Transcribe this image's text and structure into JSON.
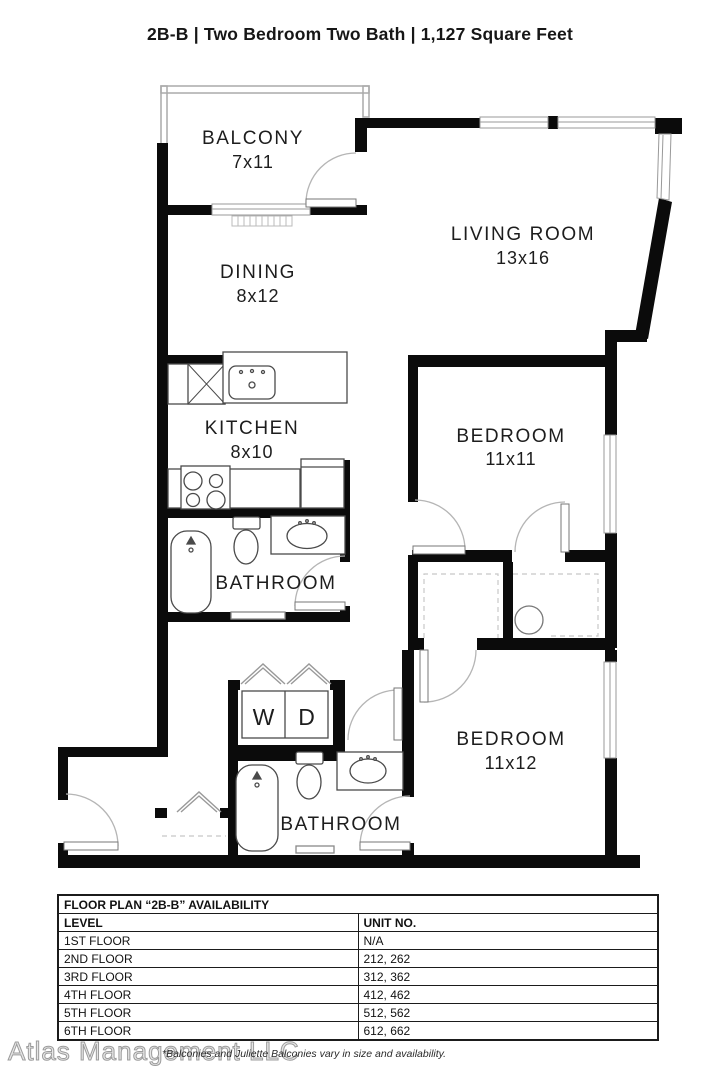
{
  "title": "2B-B | Two Bedroom Two Bath | 1,127 Square Feet",
  "plan": {
    "balcony": {
      "name": "BALCONY",
      "dims": "7x11"
    },
    "living_room": {
      "name": "LIVING ROOM",
      "dims": "13x16"
    },
    "dining": {
      "name": "DINING",
      "dims": "8x12"
    },
    "kitchen": {
      "name": "KITCHEN",
      "dims": "8x10"
    },
    "bedroom_1": {
      "name": "BEDROOM",
      "dims": "11x11"
    },
    "bathroom_1": {
      "name": "BATHROOM"
    },
    "laundry": {
      "washer": "W",
      "dryer": "D"
    },
    "bedroom_2": {
      "name": "BEDROOM",
      "dims": "11x12"
    },
    "bathroom_2": {
      "name": "BATHROOM"
    }
  },
  "availability": {
    "title": "FLOOR PLAN “2B-B” AVAILABILITY",
    "columns": {
      "level": "LEVEL",
      "unit": "UNIT NO."
    },
    "rows": [
      {
        "level": "1ST FLOOR",
        "unit": "N/A"
      },
      {
        "level": "2ND FLOOR",
        "unit": "212, 262"
      },
      {
        "level": "3RD FLOOR",
        "unit": "312, 362"
      },
      {
        "level": "4TH FLOOR",
        "unit": "412, 462"
      },
      {
        "level": "5TH FLOOR",
        "unit": "512, 562"
      },
      {
        "level": "6TH FLOOR",
        "unit": "612, 662"
      }
    ]
  },
  "footer": {
    "watermark": "Atlas Management LLC",
    "disclaimer": "*Balconies and Juliette Balconies vary in size and availability."
  }
}
